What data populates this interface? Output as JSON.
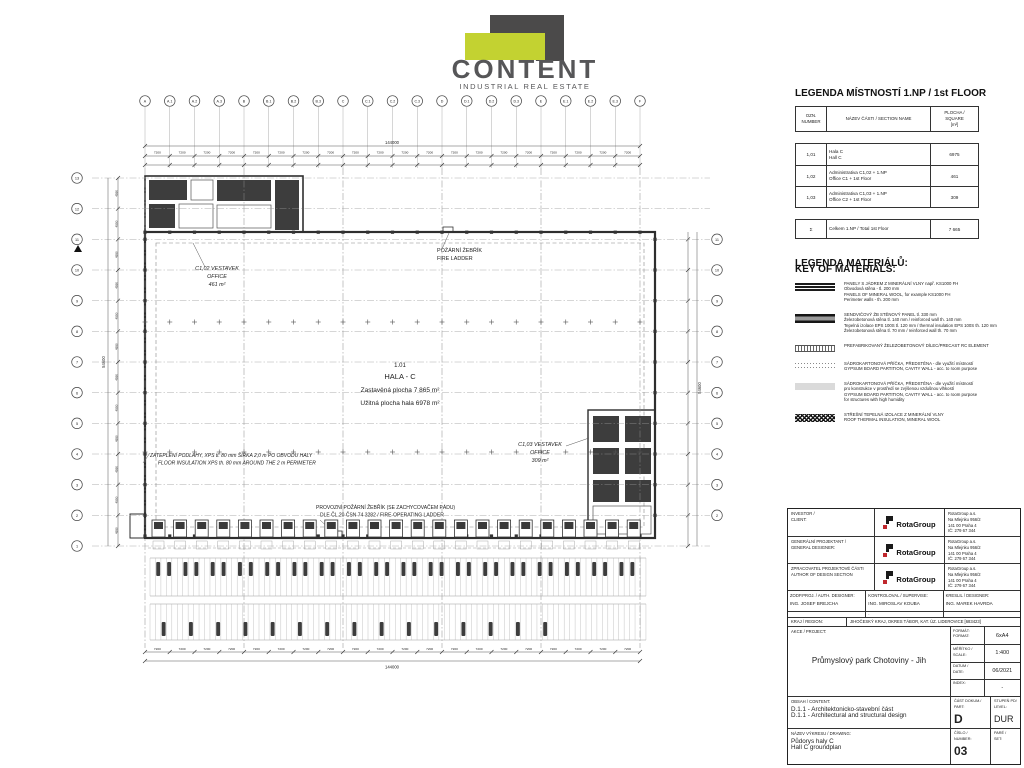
{
  "logo": {
    "name": "CONTENT",
    "tagline": "INDUSTRIAL REAL ESTATE"
  },
  "room_legend": {
    "title": "LEGENDA MÍSTNOSTÍ 1.NP / 1st FLOOR",
    "headers": {
      "num": [
        "OZN.",
        "NUMBER"
      ],
      "name": [
        "NÁZEV ČÁSTI / SECTION NAME"
      ],
      "area": [
        "PLOCHA /",
        "SQUARE",
        "[m²]"
      ]
    },
    "rows": [
      {
        "num": "1,01",
        "name": [
          "Hala C",
          "Hall C"
        ],
        "area": "6975"
      },
      {
        "num": "1,02",
        "name": [
          "Administrativa C1,02 + 1.NP",
          "Office C1 + 1st Floor"
        ],
        "area": "461"
      },
      {
        "num": "1,03",
        "name": [
          "Administrativa C1,03 + 1.NP",
          "Office C2 + 1st Floor"
        ],
        "area": "309"
      }
    ],
    "total": {
      "num": "Σ",
      "name": [
        "Celkem 1.NP / Total 1st Floor"
      ],
      "area": "7 665"
    }
  },
  "materials": {
    "title": [
      "LEGENDA MATERIÁLŮ:",
      "KEY OF MATERIALS:"
    ],
    "items": [
      {
        "symbol": "mineral-wool-panel-lines",
        "lines": [
          "PANELY S JÁDREM Z MINERÁLNÍ VLNY např. KS1000 FH",
          "Obvodová stěna - tl. 200 mm",
          "PANELS OF MINERAL WOOL, for example KS1000 FH",
          "Perimeter walls - th. 200 mm"
        ]
      },
      {
        "symbol": "sandwich-rc-panel-band",
        "lines": [
          "SENDVIČOVÝ ŽB STĚNOVÝ PANEL tl. 330 mm",
          "Železobetonová stěna tl. 140 mm / reinforced wall th. 140 mm",
          "Tepelná izolace EPS 100S tl. 120 mm / thermal insulation EPS 100S th. 120 mm",
          "Železobetonová stěna tl. 70 mm / reinforced wall th. 70 mm"
        ]
      },
      {
        "symbol": "precast-rc-hatch",
        "lines": [
          "PREFABRIKOVANÝ ŽELEZOBETONOVÝ DÍLEC/PRECAST RC ELEMENT"
        ]
      },
      {
        "symbol": "gypsum-partition-dotted",
        "lines": [
          "SÁDROKARTONOVÁ PŘÍČKA, PŘEDSTĚNA - dle využití místností",
          "GYPSUM BOARD PARTITION, CAVITY WALL - acc. to room purpose"
        ]
      },
      {
        "symbol": "gypsum-partition-humid-gray",
        "lines": [
          "SÁDROKARTONOVÁ PŘÍČKA, PŘEDSTĚNA - dle využití místností",
          "pro konstrukce v prostředí se zvýšenou vzdušnou vlhkostí",
          "GYPSUM BOARD PARTITION, CAVITY WALL - acc. to room purpose",
          "for structures with high humidity"
        ]
      },
      {
        "symbol": "roof-insulation-crosshatch",
        "lines": [
          "STŘEŠNÍ TEPELNÁ IZOLACE Z MINERÁLNÍ VLNY",
          "ROOF THERMAL INSULATION, MINERAL WOOL"
        ]
      }
    ]
  },
  "titleblock": {
    "investor_label": [
      "INVESTOR /",
      "CLIENT:"
    ],
    "designer_label": [
      "GENERÁLNÍ PROJEKTANT /",
      "GENERAL DESIGNER:"
    ],
    "author_label": [
      "ZPRACOVATEL PROJEKTOVÉ ČÁSTI",
      "AUTHOR OF DESIGN SECTION"
    ],
    "company": "RotaGroup",
    "address": [
      "RotaGroup a.s.",
      "Na Mlejnku 956/2",
      "141 00 Praha 4",
      "IČ: 279 67 344"
    ],
    "auth_designer_label": "ZODP.PROJ. / AUTH. DESIGNER:",
    "auth_designer": "ING. JOSEF BREJCHA",
    "supervisor_label": "KONTROLOVAL / SUPERVISE:",
    "supervisor": "ING. MIROSLAV KOUBA",
    "drafter_label": "KRESLIL / DESIGNER:",
    "drafter": "ING. MAREK HAVRDA",
    "dot": "·",
    "region_label": "KRAJ / REGION:",
    "region": "JIHOČESKÝ KRAJ, OKRES TÁBOR, KAT. ÚZ. LIDEROVICE [683423]",
    "project_label": "AKCE / PROJECT:",
    "project": "Průmyslový park Chotoviny - Jih",
    "format_label": [
      "FORMÁT:",
      "FORMAT:"
    ],
    "format": "6xA4",
    "scale_label": [
      "MĚŘÍTKO /",
      "SCALE:"
    ],
    "scale": "1:400",
    "date_label": [
      "DATUM /",
      "DATE:"
    ],
    "date": "06/2021",
    "index_label": [
      "INDEX:"
    ],
    "index": "-",
    "content_label": "OBSAH / CONTENT:",
    "content": [
      "D.1.1 - Architektonicko-stavební část",
      "D.1.1 - Architectural and structural design"
    ],
    "part_label": [
      "ČÁST DOKUM./",
      "PART:"
    ],
    "part": "D",
    "level_label": [
      "STUPEŇ PD/",
      "LEVEL:"
    ],
    "level": "DUR",
    "drawing_label": "NÁZEV VÝKRESU / DRAWING:",
    "drawing": [
      "Půdorys haly C",
      "Hall C groundplan"
    ],
    "number_label": [
      "ČÍSLO /",
      "NUMBER:"
    ],
    "number": "03",
    "set_label": [
      "PARÉ /",
      "SET:"
    ],
    "set": ""
  },
  "plan": {
    "grid_top": [
      "A",
      "A.1",
      "A.2",
      "A.3",
      "B",
      "B.1",
      "B.2",
      "B.3",
      "C",
      "C.1",
      "C.2",
      "C.3",
      "D",
      "D.1",
      "D.2",
      "D.3",
      "E",
      "E.1",
      "E.2",
      "E.3",
      "F"
    ],
    "grid_left": [
      "13",
      "12",
      "11",
      "10",
      "9",
      "8",
      "7",
      "6",
      "5",
      "4",
      "3",
      "2",
      "1"
    ],
    "grid_right": [
      "11",
      "10",
      "9",
      "8",
      "7",
      "6",
      "5",
      "4",
      "3",
      "2"
    ],
    "dims": {
      "top_total": "144000",
      "bay": "7200",
      "side_total": "54600",
      "row": "4550"
    },
    "labels": {
      "hall": [
        "1.01",
        "HALA - C",
        "Zastavěná plocha 7 865 m²",
        "Užitná plocha hala 6978 m²"
      ],
      "office1": [
        "C1,02 VESTAVEK",
        "OFFICE",
        "461 m²"
      ],
      "office2": [
        "C1,03 VESTAVEK",
        "OFFICE",
        "309 m²"
      ],
      "fire_ladder": [
        "POŽÁRNÍ ŽEBŘÍK",
        "FIRE LADDER"
      ],
      "insulation": [
        "ZATEPLENÍ PODLAHY, XPS tl. 80 mm ŠÍŘKA 2,0 m PO OBVODU HALY",
        "FLOOR INSULATION XPS th. 80 mm AROUND THE 2 m PERIMETER"
      ],
      "op_ladder": [
        "PROVOZNÍ POŽÁRNÍ ŽEBŘÍK (SE ZACHYCOVAČEM PÁDU)",
        "DLE ČL.20 ČSN 74 3282 / FIRE-OPERATING LADDER"
      ]
    }
  }
}
